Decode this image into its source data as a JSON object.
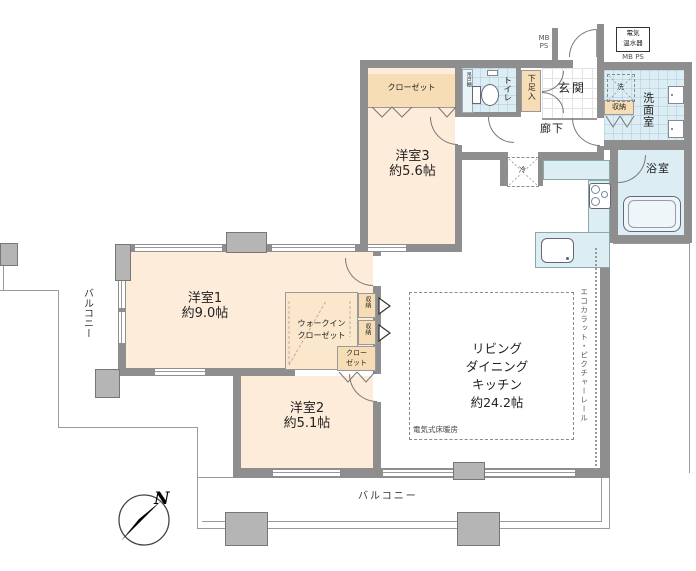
{
  "rooms": {
    "bedroom1": {
      "name": "洋室1",
      "size": "約9.0帖"
    },
    "bedroom2": {
      "name": "洋室2",
      "size": "約5.1帖"
    },
    "bedroom3": {
      "name": "洋室3",
      "size": "約5.6帖"
    },
    "ldk": {
      "line1": "リビング",
      "line2": "ダイニング",
      "line3": "キッチン",
      "size": "約24.2帖"
    },
    "entrance": "玄関",
    "hallway": "廊下",
    "toilet": "トイレ",
    "washroom": "洗面室",
    "bathroom": "浴室",
    "balcony_bottom": "バルコニー",
    "balcony_left": "バルコニー"
  },
  "storage": {
    "closet3": "クローゼット",
    "wic_line1": "ウォークイン",
    "wic_line2": "クローゼット",
    "closet2_line1": "クロー",
    "closet2_line2": "ゼット",
    "shoe_cabinet": "下足入",
    "shuno": "収納",
    "hanging_shelf": "吊戸棚"
  },
  "labels": {
    "laundry": "洗",
    "fridge": "冷",
    "floor_heating": "電気式床暖房",
    "ecocarat": "エコカラット・ピクチャーレール",
    "water_heater_line1": "電気",
    "water_heater_line2": "温水器",
    "mb": "MB",
    "ps": "PS",
    "mbps": "MB PS",
    "north": "N"
  },
  "colors": {
    "wall": "#8e8e8e",
    "room_peach": "#fcecd9",
    "closet_tan": "#f7ddb6",
    "wet_blue": "#dcedf4",
    "line": "#9a9a9a"
  }
}
